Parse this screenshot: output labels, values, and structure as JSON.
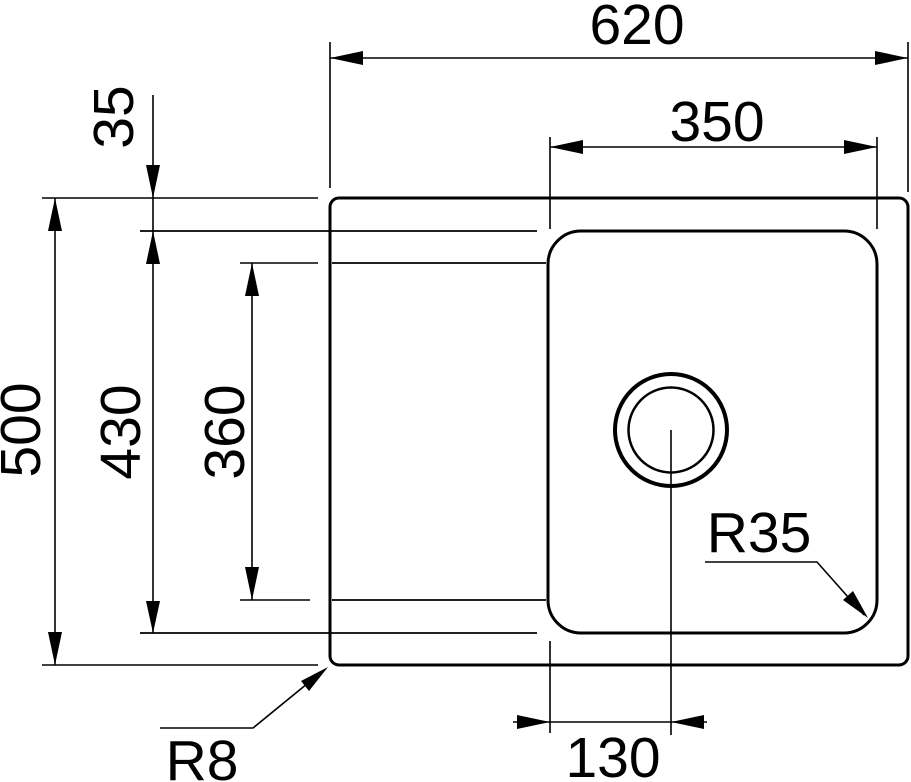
{
  "figure": {
    "type": "technical-dimension-drawing",
    "subject": "kitchen sink top view with drainboard, bowl and drain hole",
    "background_color": "#ffffff",
    "line_color": "#000000"
  },
  "dimensions": {
    "overall_width": "620",
    "bowl_width": "350",
    "rim_offset": "35",
    "overall_depth": "500",
    "inner_depth": "430",
    "drainboard_depth": "360",
    "drain_offset": "130"
  },
  "radii": {
    "bowl_corner": "R35",
    "outer_corner": "R8"
  }
}
